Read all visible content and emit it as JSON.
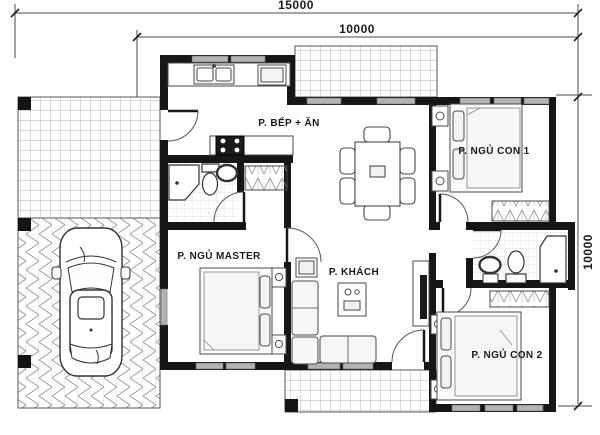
{
  "plan": {
    "title": "house-floor-plan",
    "dims": {
      "total_width": "15000",
      "main_width": "10000",
      "depth": "10000"
    },
    "rooms": [
      {
        "id": "kitchen-dining",
        "label": "P. BẾP + ĂN"
      },
      {
        "id": "bedroom-child-1",
        "label": "P. NGỦ CON 1"
      },
      {
        "id": "bedroom-master",
        "label": "P. NGỦ MASTER"
      },
      {
        "id": "living-room",
        "label": "P. KHÁCH"
      },
      {
        "id": "bedroom-child-2",
        "label": "P. NGỦ CON 2"
      }
    ],
    "colors": {
      "wall": "#161616",
      "line": "#4a4a4a",
      "window_fill": "#b3b3b3",
      "paving_line": "#8f8f8f",
      "background": "#ffffff"
    }
  }
}
